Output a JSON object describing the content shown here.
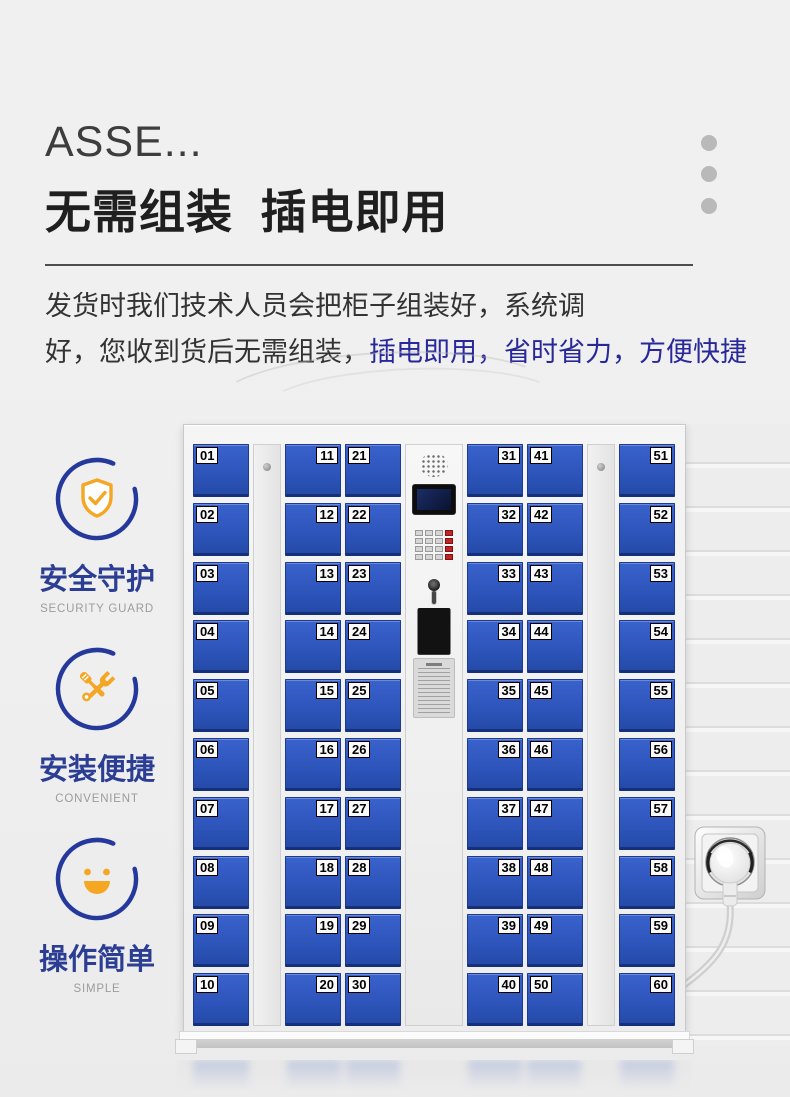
{
  "header": {
    "eyebrow": "ASSE...",
    "title": "无需组装  插电即用",
    "desc_line1": "发货时我们技术人员会把柜子组装好，系统调",
    "desc_line2_black": "好，您收到货后无需组装，",
    "desc_line2_blue": "插电即用，省时省力，方便快捷"
  },
  "features": [
    {
      "icon": "shield-check-icon",
      "title": "安全守护",
      "subtitle": "SECURITY GUARD"
    },
    {
      "icon": "tools-icon",
      "title": "安装便捷",
      "subtitle": "CONVENIENT"
    },
    {
      "icon": "smiley-icon",
      "title": "操作简单",
      "subtitle": "SIMPLE"
    }
  ],
  "locker": {
    "columns": [
      {
        "label_side": "left",
        "doors": [
          "01",
          "02",
          "03",
          "04",
          "05",
          "06",
          "07",
          "08",
          "09",
          "10"
        ]
      },
      {
        "label_side": "right",
        "doors": [
          "11",
          "12",
          "13",
          "14",
          "15",
          "16",
          "17",
          "18",
          "19",
          "20"
        ]
      },
      {
        "label_side": "left",
        "doors": [
          "21",
          "22",
          "23",
          "24",
          "25",
          "26",
          "27",
          "28",
          "29",
          "30"
        ]
      },
      {
        "label_side": "right",
        "doors": [
          "31",
          "32",
          "33",
          "34",
          "35",
          "36",
          "37",
          "38",
          "39",
          "40"
        ]
      },
      {
        "label_side": "left",
        "doors": [
          "41",
          "42",
          "43",
          "44",
          "45",
          "46",
          "47",
          "48",
          "49",
          "50"
        ]
      },
      {
        "label_side": "right",
        "doors": [
          "51",
          "52",
          "53",
          "54",
          "55",
          "56",
          "57",
          "58",
          "59",
          "60"
        ]
      }
    ],
    "control_panel_parts": [
      "speaker",
      "display-screen",
      "keypad",
      "key-lock",
      "card-slot-window",
      "instruction-sticker"
    ]
  },
  "colors": {
    "door_blue": "#2b53b8",
    "accent_blue": "#2c3e94",
    "accent_orange": "#f5a623",
    "desc_blue": "#28289a",
    "dots_gray": "#b9b9b9"
  }
}
